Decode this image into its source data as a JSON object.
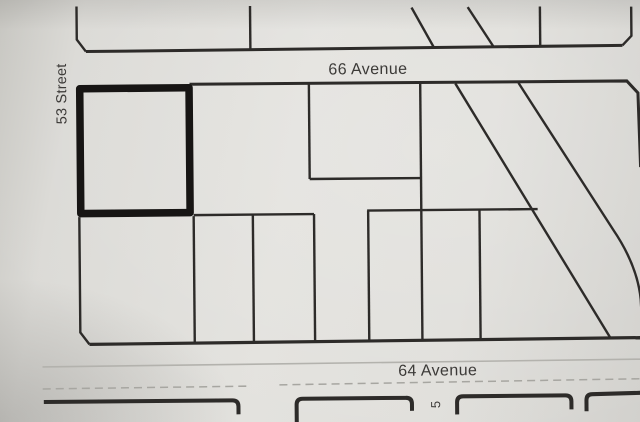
{
  "labels": {
    "top_avenue": "66 Avenue",
    "bottom_avenue": "64 Avenue",
    "left_street": "53 Street",
    "bottom_street_partial": "5"
  },
  "colors": {
    "paper": "#e0dfdb",
    "ink": "#2d2b29",
    "highlight": "#171514",
    "faint": "#b3b2ad",
    "faintdash": "#a7a6a1",
    "label": "#3c3a38"
  }
}
